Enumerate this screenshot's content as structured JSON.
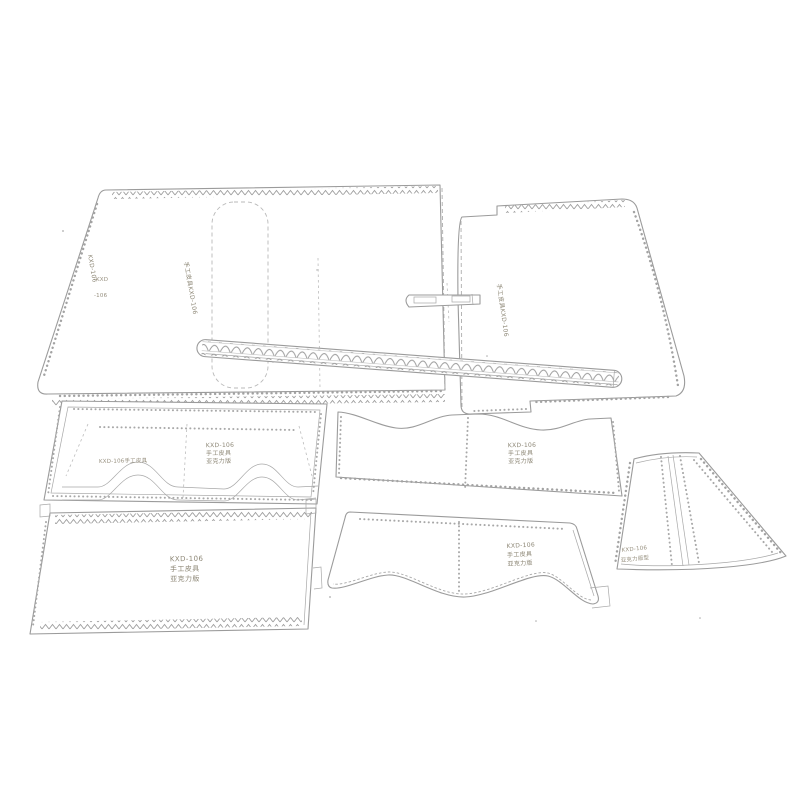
{
  "meta": {
    "type": "product-photo",
    "subject": "clear acrylic leathercraft sewing pattern template set with stitch-hole borders",
    "background_color": "#ffffff",
    "line_color": "#9b9b9b",
    "engraving_color": "#8d8776"
  },
  "pieces": {
    "main_body": {
      "label_side_vertical": "KXD-106",
      "label_small_top": "KXD",
      "label_small_bottom": "-106",
      "label_center_vertical": "手工皮具KXD-106"
    },
    "flap": {
      "label_vertical": "手工皮具KXD-106"
    },
    "pocket_panel": {
      "label_left": "KXD-106手工皮具",
      "l1": "KXD-106",
      "l2": "手工皮具",
      "l3": "亚克力版"
    },
    "divider_panel": {
      "l1": "KXD-106",
      "l2": "手工皮具",
      "l3": "亚克力版"
    },
    "back_panel": {
      "l1": "KXD-106",
      "l2": "手工皮具",
      "l3": "亚克力版"
    },
    "front_panel": {
      "l1": "KXD-106",
      "l2": "手工皮具",
      "l3": "亚克力版"
    },
    "gusset": {
      "l1": "KXD-106",
      "l2": "亚克力版型"
    }
  }
}
